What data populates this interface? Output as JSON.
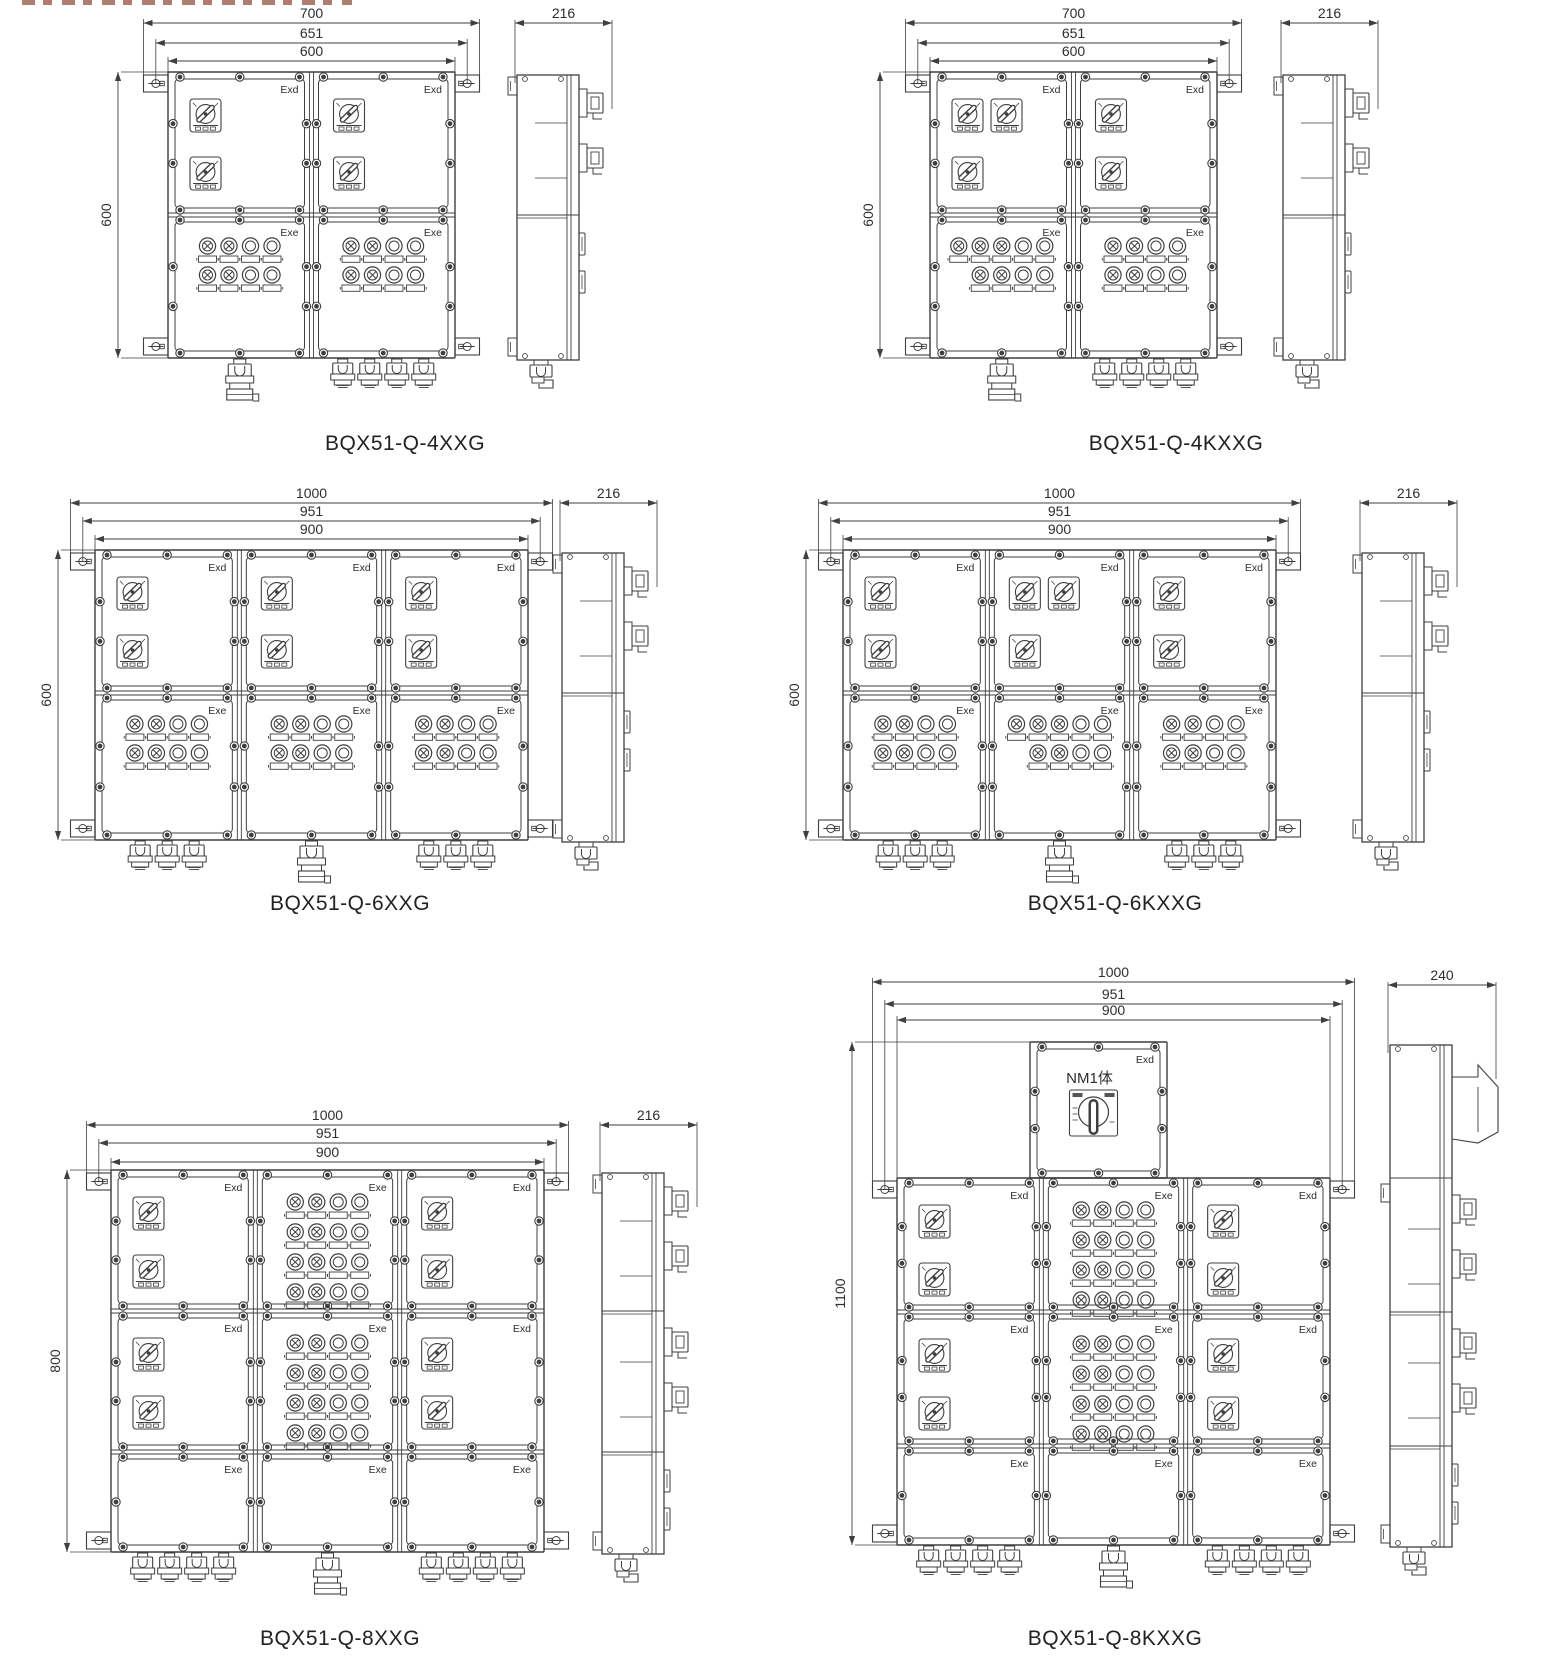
{
  "sheet": {
    "width": 1553,
    "height": 1662,
    "background": "#ffffff",
    "ink": "#3f3f3f",
    "text_color": "#2e2e2e"
  },
  "cropped_heading_fragment": {
    "present": true
  },
  "diagrams": [
    {
      "id": "bqx51-q-4xxg",
      "model": "BQX51-Q-4XXG",
      "label_pos": [
        395,
        445
      ],
      "box": [
        168,
        72,
        287,
        286
      ],
      "cols": 2,
      "row_heights": [
        143,
        143
      ],
      "cells": [
        [
          {
            "label": "Exd",
            "content": "sw2v"
          },
          {
            "label": "Exd",
            "content": "sw2v"
          }
        ],
        [
          {
            "label": "Exe",
            "content": "lights",
            "pattern": [
              [
                1,
                1,
                0,
                0
              ],
              [
                1,
                1,
                0,
                0
              ]
            ]
          },
          {
            "label": "Exe",
            "content": "lights",
            "pattern": [
              [
                1,
                1,
                0,
                0
              ],
              [
                1,
                1,
                0,
                0
              ]
            ]
          }
        ]
      ],
      "glands": [
        {
          "col": 0,
          "type": "large",
          "count": 1
        },
        {
          "col": 1,
          "type": "small",
          "count": 4
        }
      ],
      "dims_top": [
        {
          "label": "700",
          "offset": 24.5,
          "y": 23
        },
        {
          "label": "651",
          "offset": 12.2,
          "y": 43
        },
        {
          "label": "600",
          "offset": 0,
          "y": 61
        }
      ],
      "dim_left": {
        "label": "600",
        "x": 118
      },
      "side": {
        "x": 517,
        "dim_label": "216",
        "dim_y": 23,
        "dim_w": 97
      }
    },
    {
      "id": "bqx51-q-4kxxg",
      "model": "BQX51-Q-4KXXG",
      "label_pos": [
        1166,
        445
      ],
      "box": [
        930,
        72,
        287,
        286
      ],
      "cols": 2,
      "row_heights": [
        143,
        143
      ],
      "cells": [
        [
          {
            "label": "Exd",
            "content": "sw2h1"
          },
          {
            "label": "Exd",
            "content": "sw2v"
          }
        ],
        [
          {
            "label": "Exe",
            "content": "lights",
            "pattern": [
              [
                1,
                1,
                1,
                0,
                0
              ],
              [
                null,
                1,
                1,
                0,
                0
              ]
            ]
          },
          {
            "label": "Exe",
            "content": "lights",
            "pattern": [
              [
                1,
                1,
                0,
                0
              ],
              [
                1,
                1,
                0,
                0
              ]
            ]
          }
        ]
      ],
      "glands": [
        {
          "col": 0,
          "type": "large",
          "count": 1
        },
        {
          "col": 1,
          "type": "small",
          "count": 4
        }
      ],
      "dims_top": [
        {
          "label": "700",
          "offset": 24.5,
          "y": 23
        },
        {
          "label": "651",
          "offset": 12.2,
          "y": 43
        },
        {
          "label": "600",
          "offset": 0,
          "y": 61
        }
      ],
      "dim_left": {
        "label": "600",
        "x": 880
      },
      "side": {
        "x": 1283,
        "dim_label": "216",
        "dim_y": 23,
        "dim_w": 97
      }
    },
    {
      "id": "bqx51-q-6xxg",
      "model": "BQX51-Q-6XXG",
      "label_pos": [
        340,
        905
      ],
      "box": [
        95,
        550,
        433,
        290
      ],
      "cols": 3,
      "row_heights": [
        143,
        147
      ],
      "cells": [
        [
          {
            "label": "Exd",
            "content": "sw2v"
          },
          {
            "label": "Exd",
            "content": "sw2v"
          },
          {
            "label": "Exd",
            "content": "sw2v"
          }
        ],
        [
          {
            "label": "Exe",
            "content": "lights",
            "pattern": [
              [
                1,
                1,
                0,
                0
              ],
              [
                1,
                1,
                0,
                0
              ]
            ]
          },
          {
            "label": "Exe",
            "content": "lights",
            "pattern": [
              [
                1,
                1,
                0,
                0
              ],
              [
                1,
                1,
                0,
                0
              ]
            ]
          },
          {
            "label": "Exe",
            "content": "lights",
            "pattern": [
              [
                1,
                1,
                0,
                0
              ],
              [
                1,
                1,
                0,
                0
              ]
            ]
          }
        ]
      ],
      "glands": [
        {
          "col": 0,
          "type": "small",
          "count": 3
        },
        {
          "col": 1,
          "type": "large",
          "count": 1
        },
        {
          "col": 2,
          "type": "small",
          "count": 3
        }
      ],
      "dims_top": [
        {
          "label": "1000",
          "offset": 24.5,
          "y": 503
        },
        {
          "label": "951",
          "offset": 12.2,
          "y": 521
        },
        {
          "label": "900",
          "offset": 0,
          "y": 539
        }
      ],
      "dim_left": {
        "label": "600",
        "x": 58
      },
      "side": {
        "x": 562,
        "dim_label": "216",
        "dim_y": 503,
        "dim_w": 97
      }
    },
    {
      "id": "bqx51-q-6kxxg",
      "model": "BQX51-Q-6KXXG",
      "label_pos": [
        1105,
        905
      ],
      "box": [
        843,
        550,
        433,
        290
      ],
      "cols": 3,
      "row_heights": [
        143,
        147
      ],
      "cells": [
        [
          {
            "label": "Exd",
            "content": "sw2v"
          },
          {
            "label": "Exd",
            "content": "sw2h1"
          },
          {
            "label": "Exd",
            "content": "sw2v"
          }
        ],
        [
          {
            "label": "Exe",
            "content": "lights",
            "pattern": [
              [
                1,
                1,
                0,
                0
              ],
              [
                1,
                1,
                0,
                0
              ]
            ]
          },
          {
            "label": "Exe",
            "content": "lights",
            "pattern": [
              [
                1,
                1,
                1,
                0,
                0
              ],
              [
                null,
                1,
                1,
                0,
                0
              ]
            ]
          },
          {
            "label": "Exe",
            "content": "lights",
            "pattern": [
              [
                1,
                1,
                0,
                0
              ],
              [
                1,
                1,
                0,
                0
              ]
            ]
          }
        ]
      ],
      "glands": [
        {
          "col": 0,
          "type": "small",
          "count": 3
        },
        {
          "col": 1,
          "type": "large",
          "count": 1
        },
        {
          "col": 2,
          "type": "small",
          "count": 3
        }
      ],
      "dims_top": [
        {
          "label": "1000",
          "offset": 24.5,
          "y": 503
        },
        {
          "label": "951",
          "offset": 12.2,
          "y": 521
        },
        {
          "label": "900",
          "offset": 0,
          "y": 539
        }
      ],
      "dim_left": {
        "label": "600",
        "x": 806
      },
      "side": {
        "x": 1362,
        "dim_label": "216",
        "dim_y": 503,
        "dim_w": 97
      }
    },
    {
      "id": "bqx51-q-8xxg",
      "model": "BQX51-Q-8XXG",
      "label_pos": [
        330,
        1640
      ],
      "box": [
        111,
        1170,
        433,
        382
      ],
      "cols": 3,
      "row_heights": [
        141,
        141,
        100
      ],
      "cells": [
        [
          {
            "label": "Exd",
            "content": "sw2v"
          },
          {
            "label": "Exe",
            "content": "lights",
            "pattern": [
              [
                1,
                1,
                0,
                0
              ],
              [
                1,
                1,
                0,
                0
              ],
              [
                1,
                1,
                0,
                0
              ],
              [
                1,
                1,
                0,
                0
              ]
            ]
          },
          {
            "label": "Exd",
            "content": "sw2v"
          }
        ],
        [
          {
            "label": "Exd",
            "content": "sw2v"
          },
          {
            "label": "Exe",
            "content": "lights",
            "pattern": [
              [
                1,
                1,
                0,
                0
              ],
              [
                1,
                1,
                0,
                0
              ],
              [
                1,
                1,
                0,
                0
              ],
              [
                1,
                1,
                0,
                0
              ]
            ]
          },
          {
            "label": "Exd",
            "content": "sw2v"
          }
        ],
        [
          {
            "label": "Exe",
            "content": "empty"
          },
          {
            "label": "Exe",
            "content": "empty"
          },
          {
            "label": "Exe",
            "content": "empty"
          }
        ]
      ],
      "glands": [
        {
          "col": 0,
          "type": "small",
          "count": 4
        },
        {
          "col": 1,
          "type": "large",
          "count": 1
        },
        {
          "col": 2,
          "type": "small",
          "count": 4
        }
      ],
      "dims_top": [
        {
          "label": "1000",
          "offset": 24.5,
          "y": 1125
        },
        {
          "label": "951",
          "offset": 12.2,
          "y": 1143
        },
        {
          "label": "900",
          "offset": 0,
          "y": 1162
        }
      ],
      "dim_left": {
        "label": "800",
        "x": 67
      },
      "side": {
        "x": 602,
        "dim_label": "216",
        "dim_y": 1125,
        "dim_w": 97
      }
    },
    {
      "id": "bqx51-q-8kxxg",
      "model": "BQX51-Q-8KXXG",
      "label_pos": [
        1105,
        1640
      ],
      "box": [
        897,
        1178,
        433,
        367
      ],
      "cols": 3,
      "row_heights": [
        134,
        134,
        99
      ],
      "top_comp": {
        "x": 1030,
        "y": 1042,
        "w": 137,
        "h": 136,
        "label": "Exd",
        "switch_label": "NM1体"
      },
      "cells": [
        [
          {
            "label": "Exd",
            "content": "sw2v"
          },
          {
            "label": "Exe",
            "content": "lights",
            "pattern": [
              [
                1,
                1,
                0,
                0
              ],
              [
                1,
                1,
                0,
                0
              ],
              [
                1,
                1,
                0,
                0
              ],
              [
                1,
                1,
                0,
                0
              ]
            ]
          },
          {
            "label": "Exd",
            "content": "sw2v"
          }
        ],
        [
          {
            "label": "Exd",
            "content": "sw2v"
          },
          {
            "label": "Exe",
            "content": "lights",
            "pattern": [
              [
                1,
                1,
                0,
                0
              ],
              [
                1,
                1,
                0,
                0
              ],
              [
                1,
                1,
                0,
                0
              ],
              [
                1,
                1,
                0,
                0
              ]
            ]
          },
          {
            "label": "Exd",
            "content": "sw2v"
          }
        ],
        [
          {
            "label": "Exe",
            "content": "empty"
          },
          {
            "label": "Exe",
            "content": "empty"
          },
          {
            "label": "Exe",
            "content": "empty"
          }
        ]
      ],
      "glands": [
        {
          "col": 0,
          "type": "small",
          "count": 4
        },
        {
          "col": 1,
          "type": "large",
          "count": 1
        },
        {
          "col": 2,
          "type": "small",
          "count": 4
        }
      ],
      "dims_top": [
        {
          "label": "1000",
          "offset": 24.5,
          "y": 982
        },
        {
          "label": "951",
          "offset": 12.2,
          "y": 1004
        },
        {
          "label": "900",
          "offset": 0,
          "y": 1020
        }
      ],
      "dim_left": {
        "label": "1100",
        "x": 852,
        "y1": 1042,
        "y2": 1545
      },
      "side": {
        "x": 1390,
        "dim_label": "240",
        "dim_y": 985,
        "dim_w": 108,
        "top_section": [
          1045,
          1178
        ]
      }
    }
  ]
}
